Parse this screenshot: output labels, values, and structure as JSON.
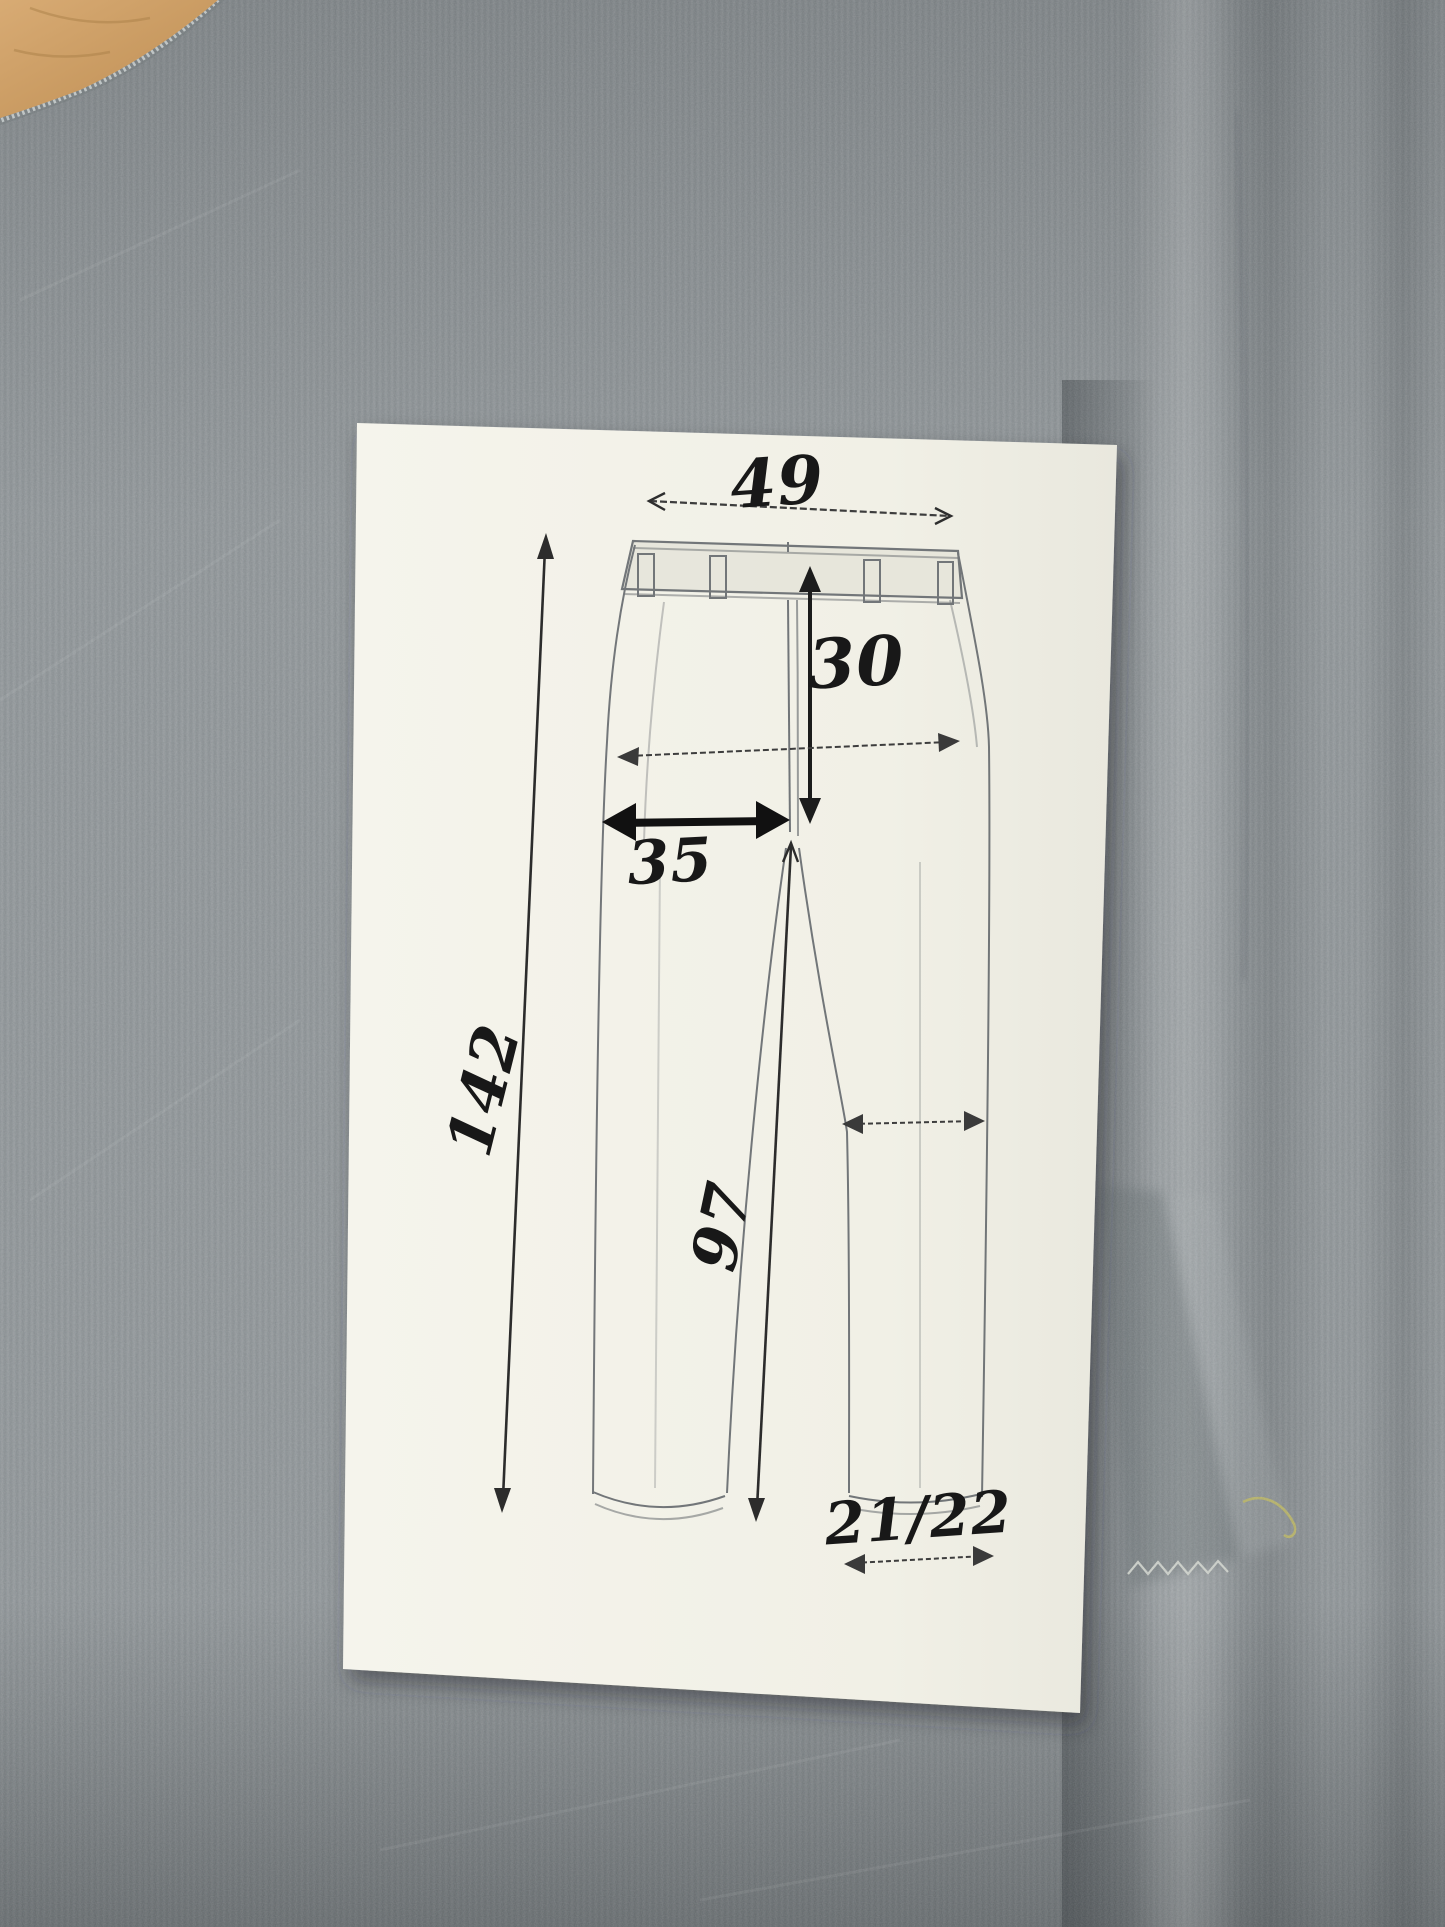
{
  "photo": {
    "subject": "Hand-drawn trouser measurement diagram on a sheet of paper, photographed on gray knit fabric",
    "paper_color": "#f3f2e8",
    "fabric_color": "#8f9598",
    "fabric_shadow_color": "#5f676b",
    "wood_color": "#cb9d64",
    "ink_color": "#1a1a1a",
    "pencil_color": "#686c70",
    "stitch_color": "#d6d9d1",
    "thread_color": "#b9b464"
  },
  "measurements": {
    "waist": "49",
    "rise": "30",
    "front": "35",
    "side_length": "142",
    "inseam": "97",
    "hem": "21/22"
  }
}
